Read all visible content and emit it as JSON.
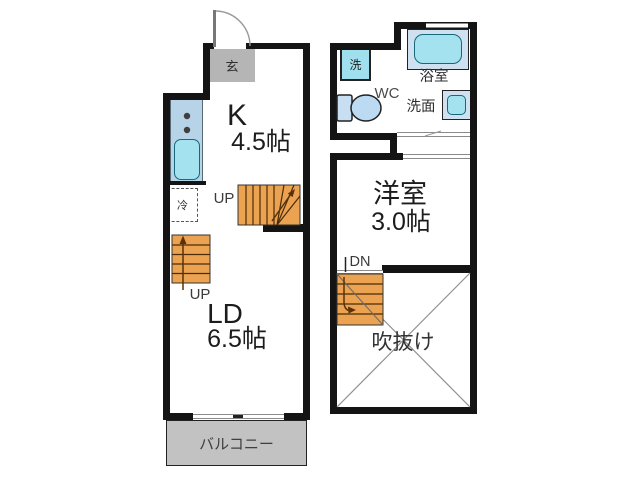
{
  "title": "maisonette-floor-plan",
  "floor1": {
    "entrance": "玄",
    "kitchen": "K",
    "kitchen_size": "4.5帖",
    "fridge": "冷",
    "stairs_up_a": "UP",
    "stairs_up_b": "UP",
    "living_dining": "LD",
    "living_dining_size": "6.5帖",
    "balcony": "バルコニー"
  },
  "floor2": {
    "washer": "洗",
    "bathroom": "浴室",
    "toilet": "WC",
    "washbasin": "洗面",
    "western_room": "洋室",
    "western_room_size": "3.0帖",
    "stairs_down": "DN",
    "atrium": "吹抜け"
  },
  "colors": {
    "wall": "#141414",
    "stair_fill": "#eba352",
    "gray_fill": "#c2c2c2",
    "fixture_cyan": "#a5e2ef",
    "fixture_pale": "#cfe0f1",
    "counter_blue": "#b7d3e8"
  }
}
